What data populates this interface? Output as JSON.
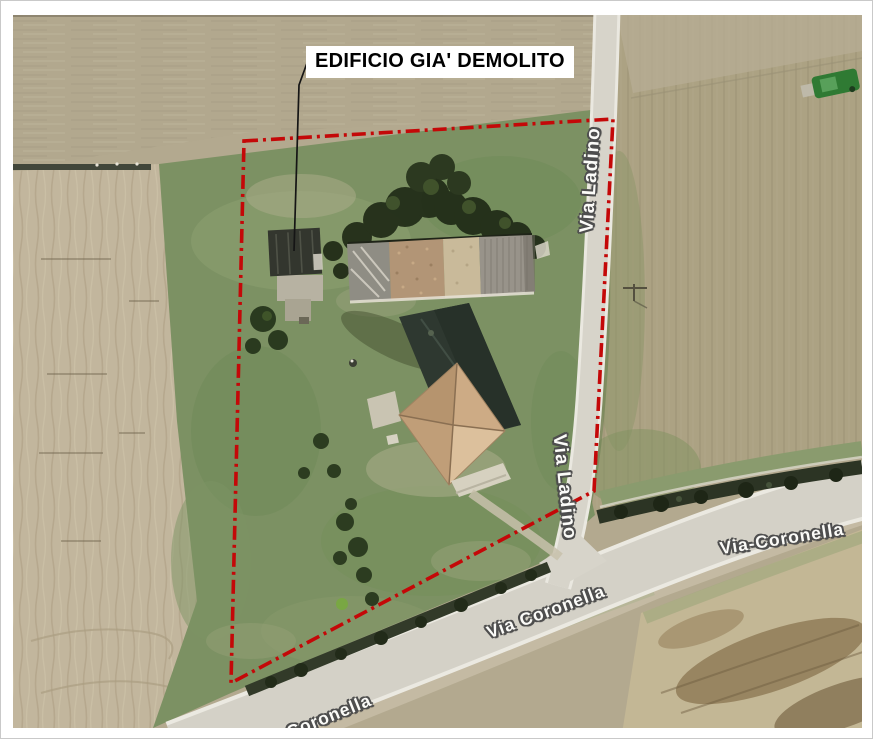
{
  "figure": {
    "type": "aerial photo with cadastral annotation",
    "frame_color": "#ffffff"
  },
  "annotation": {
    "demolished_label": "EDIFICIO GIA' DEMOLITO",
    "boundary_color": "#c40808",
    "boundary_style": "dash-dot",
    "leader_color": "#151515"
  },
  "roads": {
    "ladino_top_label": "Via Ladino",
    "ladino_mid_label": "Via Ladino",
    "coronella_right_label": "Via-Coronella",
    "coronella_mid_label": "Via Coronella",
    "coronella_partial_label": "Via Coronella",
    "label_color": "#fbfbf8"
  },
  "colors": {
    "field_top": "#b2a88e",
    "field_plowed": "#c2b69d",
    "field_east": "#aca283",
    "field_southeast": "#c3b795",
    "grass_parcel": "#7c9163",
    "road_asphalt": "#d4d1c7",
    "road_edge": "#ebe9e1",
    "hedge": "#2c3424",
    "house_roof": "#cdab85",
    "barn_brick_roof": "#b29576"
  }
}
